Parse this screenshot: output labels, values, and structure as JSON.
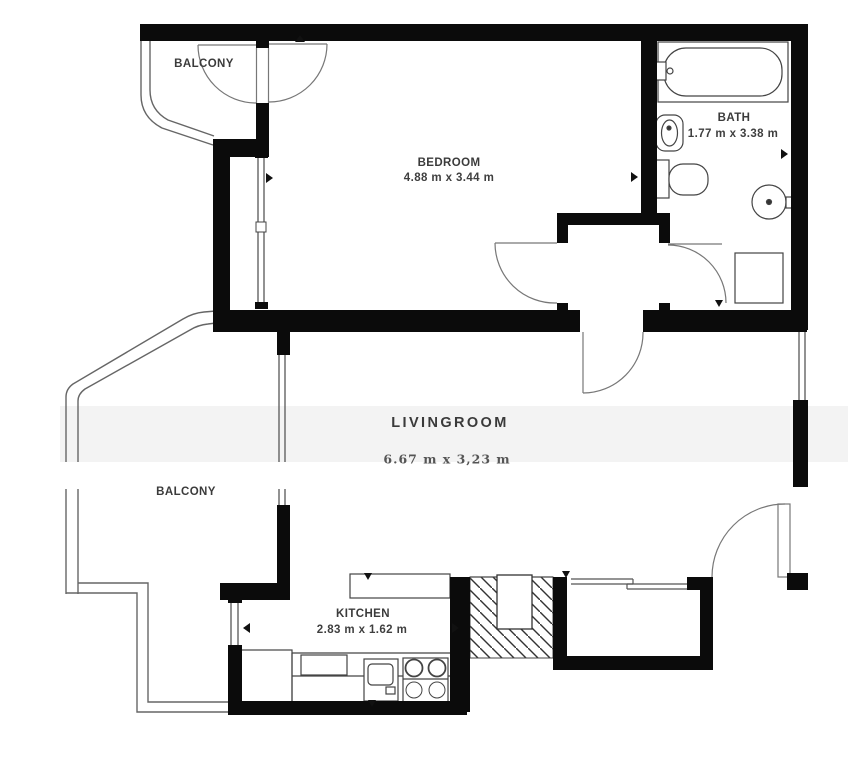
{
  "floorplan": {
    "type": "apartment-floor-plan",
    "colors": {
      "background": "#ffffff",
      "walls": "#0b0b0b",
      "thin_lines": "#666666",
      "text": "#3b3b3b",
      "watermark_band": "#f3f3f3"
    },
    "rooms": [
      {
        "id": "balcony-top",
        "label": "BALCONY",
        "dimensions": ""
      },
      {
        "id": "bedroom",
        "label": "BEDROOM",
        "dimensions": "4.88 m x 3.44 m"
      },
      {
        "id": "bath",
        "label": "BATH",
        "dimensions": "1.77 m x 3.38 m"
      },
      {
        "id": "livingroom",
        "label": "LIVINGROOM",
        "dimensions": "6.67 m x 3,23 m"
      },
      {
        "id": "balcony-left",
        "label": "BALCONY",
        "dimensions": ""
      },
      {
        "id": "kitchen",
        "label": "KITCHEN",
        "dimensions": "2.83 m x 1.62 m"
      }
    ],
    "fixtures": [
      "bathtub",
      "washbasin",
      "toilet",
      "round-basin",
      "shower",
      "kitchen-cabinet",
      "kitchen-sink",
      "stove",
      "counter-bar",
      "service-shaft",
      "sliding-door",
      "entrance-door"
    ]
  }
}
